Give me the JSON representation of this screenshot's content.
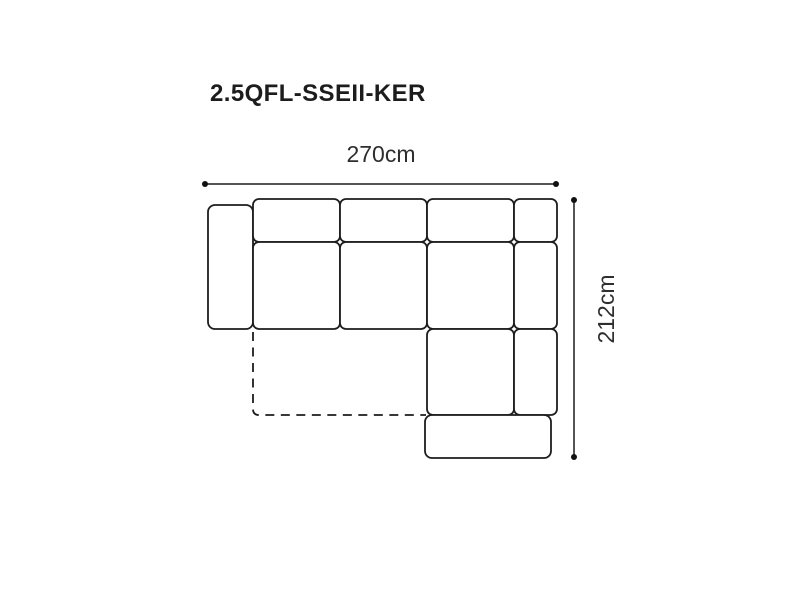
{
  "page": {
    "background_color": "#ffffff"
  },
  "header": {
    "product_code": "2.5QFL-SSEII-KER"
  },
  "diagram": {
    "width_dimension": {
      "label": "270cm",
      "value_cm": 270
    },
    "height_dimension": {
      "label": "212cm",
      "value_cm": 212
    },
    "colors": {
      "line": "#1d1d1d",
      "title_text": "#1c1c1c",
      "dimension_text": "#2e2e2e"
    }
  }
}
